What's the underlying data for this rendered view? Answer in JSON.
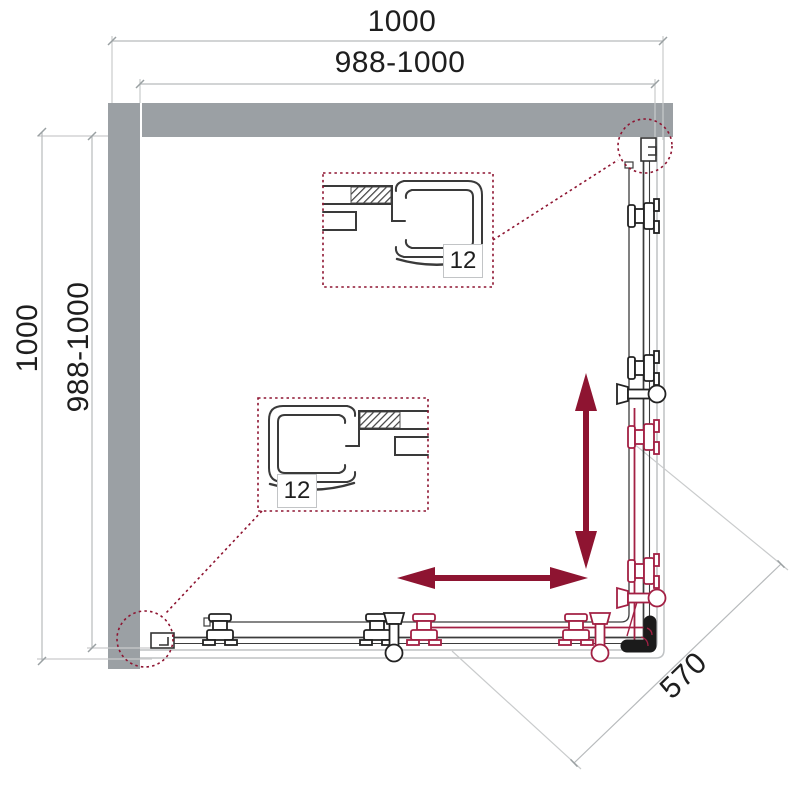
{
  "drawing": {
    "type": "shower-enclosure-plan-view",
    "dimensions": {
      "top_outer": "1000",
      "top_inner": "988-1000",
      "left_outer": "1000",
      "left_inner": "988-1000",
      "diagonal_entry": "570"
    },
    "details": {
      "glass_thickness_top": "12",
      "glass_thickness_bottom": "12"
    },
    "colors": {
      "accent_red": "#8e1431",
      "hardware_red": "#a32044",
      "wall_gray": "#9ba0a4",
      "dim_line_gray": "#b7babc",
      "line_dark": "#3c3c3c",
      "bracket_black": "#1b1b1b"
    }
  }
}
